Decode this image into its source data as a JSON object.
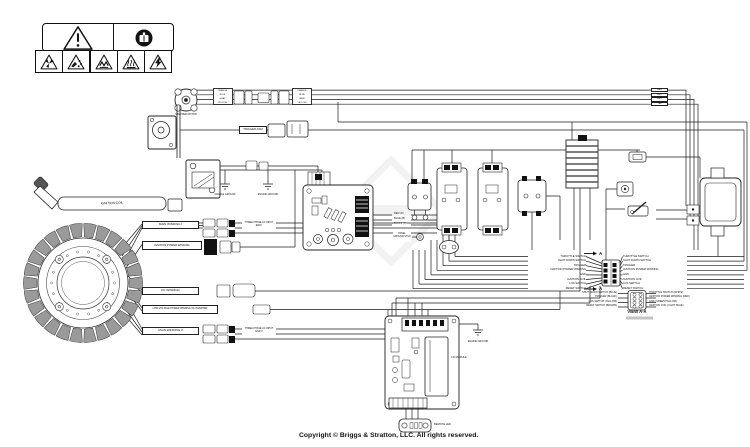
{
  "diagram": {
    "copyright": "Copyright © Briggs & Stratton, LLC. All rights reserved."
  },
  "warning_icons": [
    "general-alert",
    "read-manual",
    "rotating-blades",
    "thrown-object",
    "entanglement",
    "hot-surface",
    "electric-shock"
  ],
  "stator": {
    "windings": [
      "MAIN WINDING I",
      "IGNITION POWER WINDING",
      "DC WINDING",
      "LOW-VOLTAGE POWER WINDING OF INVERTER",
      "MAIN WINDING II"
    ],
    "phase_input_1": "THREE PHASE AC INPUT END I",
    "phase_input_2": "THREE PHASE AC INPUT END II"
  },
  "engine_side": {
    "stepper_motor": "STEPPER MOTOR",
    "stepper_wire_colors": [
      "ORANGE",
      "BLUE",
      "GRAY",
      "YELLOW"
    ],
    "trigger": "TRIGGER ASM",
    "ignition_coil": "IGNITION COIL",
    "cradle_ground": "CRADLE GROUND",
    "engine_ground": "ENGINE GROUND"
  },
  "inverter_module": {
    "wires": [
      "RED (D)",
      "BLUE (B)",
      "BLACK (F)"
    ],
    "panel_ground": "PANEL GROUND STUD"
  },
  "bundle_labels": [
    "RED",
    "BLU",
    "GRY",
    "YEL"
  ],
  "harness": {
    "section_arrow": "A",
    "left": [
      "THROTTLE SWITCH",
      "SHUT DOWN SWITCH",
      "TRIGGER",
      "IGNITION POWER WINDING",
      "GND",
      "IGNITION COIL",
      "LOS SWITCH",
      "RESET SWITCH"
    ],
    "right": [
      "THROTTLE SWITCH",
      "SHUT DOWN SWITCH",
      "TRIGGER",
      "IGNITION POWER WINDING",
      "GND",
      "IGNITION COIL",
      "LOS SWITCH",
      "RESET SWITCH"
    ]
  },
  "view_aa": {
    "title": "VIEW A-A",
    "left": [
      "SHUT DOWN SWITCH (BLUE)",
      "TRIGGER (BLACK)",
      "LOS SWITCH (YELLOW)",
      "RESET SWITCH (BROWN)"
    ],
    "right": [
      "THROTTLE SWITCH (WHITE)",
      "IGNITION POWER WINDING (RED)",
      "GND (GREEN/YELLOW)",
      "IGNITION COIL (LIGHT BLUE)"
    ]
  },
  "co_module": {
    "name": "CO MODULE",
    "engine_ground": "ENGINE GROUND",
    "remote_led": "REMOTE LED"
  },
  "colors": {
    "line": "#1c1c1c",
    "dark_fill": "#111111",
    "metal": "#9a9a9a"
  }
}
